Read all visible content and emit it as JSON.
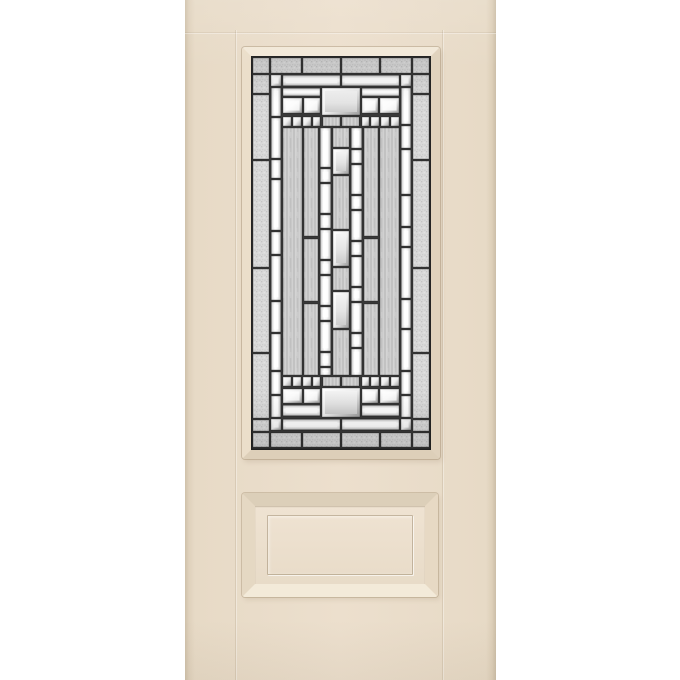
{
  "scene": {
    "background": "#ffffff",
    "subject": "smooth-skin entry door, 3/4 decorative glass lite over one raised panel"
  },
  "door": {
    "colors": {
      "bg": "#ffffff",
      "face": "#e9dcc9",
      "face_hi": "#ecdfcd",
      "trim": "#e7dac6",
      "edge": "#ccbea7"
    },
    "lite": {
      "caming": "#383838",
      "caming_edge": "#242424",
      "palette": {
        "granite_glass": "#d9d9d9",
        "streaked_glass": "#cacaca",
        "bevel_white": "#ffffff",
        "bevel_edge": "#6e6e6e",
        "frost_panel": "#e4e4e4"
      },
      "kinds": {
        "g": "granite-textured-border-glass",
        "s": "streaked-glass",
        "v": "vertical-bevel-bar",
        "h": "horizontal-bevel-bar",
        "q": "bevel-square",
        "d": "dentil-square",
        "f": "bevel-framed-frost-panel"
      },
      "pieces": [
        [
          "g",
          2,
          2,
          16,
          15
        ],
        [
          "g",
          20,
          2,
          30,
          15
        ],
        [
          "g",
          52,
          2,
          37,
          15
        ],
        [
          "g",
          91,
          2,
          37,
          15
        ],
        [
          "g",
          130,
          2,
          30,
          15
        ],
        [
          "g",
          162,
          2,
          16,
          15
        ],
        [
          "g",
          2,
          19,
          16,
          18
        ],
        [
          "g",
          2,
          39,
          16,
          64
        ],
        [
          "g",
          2,
          105,
          16,
          106
        ],
        [
          "g",
          2,
          213,
          16,
          83
        ],
        [
          "g",
          2,
          298,
          16,
          64
        ],
        [
          "g",
          2,
          364,
          16,
          11
        ],
        [
          "g",
          162,
          19,
          16,
          18
        ],
        [
          "g",
          162,
          39,
          16,
          64
        ],
        [
          "g",
          162,
          105,
          16,
          106
        ],
        [
          "g",
          162,
          213,
          16,
          83
        ],
        [
          "g",
          162,
          298,
          16,
          64
        ],
        [
          "g",
          162,
          364,
          16,
          11
        ],
        [
          "g",
          2,
          377,
          16,
          14
        ],
        [
          "g",
          20,
          377,
          30,
          14
        ],
        [
          "g",
          52,
          377,
          37,
          14
        ],
        [
          "g",
          91,
          377,
          37,
          14
        ],
        [
          "g",
          130,
          377,
          30,
          14
        ],
        [
          "g",
          162,
          377,
          16,
          14
        ],
        [
          "v",
          20,
          32,
          10,
          28
        ],
        [
          "v",
          20,
          62,
          10,
          40
        ],
        [
          "v",
          20,
          104,
          10,
          18
        ],
        [
          "v",
          20,
          124,
          10,
          50
        ],
        [
          "v",
          20,
          176,
          10,
          22
        ],
        [
          "v",
          20,
          200,
          10,
          44
        ],
        [
          "v",
          20,
          246,
          10,
          30
        ],
        [
          "v",
          20,
          278,
          10,
          36
        ],
        [
          "v",
          20,
          316,
          10,
          22
        ],
        [
          "v",
          20,
          340,
          10,
          21
        ],
        [
          "v",
          150,
          32,
          10,
          36
        ],
        [
          "v",
          150,
          70,
          10,
          22
        ],
        [
          "v",
          150,
          94,
          10,
          44
        ],
        [
          "v",
          150,
          140,
          10,
          30
        ],
        [
          "v",
          150,
          172,
          10,
          18
        ],
        [
          "v",
          150,
          192,
          10,
          50
        ],
        [
          "v",
          150,
          244,
          10,
          28
        ],
        [
          "v",
          150,
          274,
          10,
          40
        ],
        [
          "v",
          150,
          316,
          10,
          22
        ],
        [
          "v",
          150,
          340,
          10,
          21
        ],
        [
          "q",
          20,
          19,
          10,
          11
        ],
        [
          "q",
          150,
          19,
          10,
          11
        ],
        [
          "q",
          20,
          363,
          10,
          11
        ],
        [
          "q",
          150,
          363,
          10,
          11
        ],
        [
          "h",
          32,
          19,
          57,
          11
        ],
        [
          "h",
          91,
          19,
          57,
          11
        ],
        [
          "h",
          32,
          32,
          37,
          8
        ],
        [
          "h",
          111,
          32,
          37,
          8
        ],
        [
          "f",
          71,
          32,
          38,
          27
        ],
        [
          "q",
          32,
          42,
          19,
          15
        ],
        [
          "q",
          53,
          42,
          16,
          15
        ],
        [
          "q",
          111,
          42,
          16,
          15
        ],
        [
          "q",
          129,
          42,
          19,
          15
        ],
        [
          "d",
          32,
          61,
          8,
          9
        ],
        [
          "d",
          42,
          61,
          8,
          9
        ],
        [
          "d",
          52,
          61,
          8,
          9
        ],
        [
          "d",
          62,
          61,
          7,
          9
        ],
        [
          "d",
          111,
          61,
          7,
          9
        ],
        [
          "d",
          120,
          61,
          8,
          9
        ],
        [
          "d",
          130,
          61,
          8,
          9
        ],
        [
          "d",
          140,
          61,
          8,
          9
        ],
        [
          "s",
          72,
          61,
          17,
          9
        ],
        [
          "s",
          91,
          61,
          17,
          9
        ],
        [
          "s",
          32,
          72,
          19,
          247
        ],
        [
          "s",
          129,
          72,
          19,
          247
        ],
        [
          "s",
          53,
          72,
          14,
          108
        ],
        [
          "s",
          53,
          183,
          14,
          62
        ],
        [
          "s",
          53,
          248,
          14,
          71
        ],
        [
          "s",
          113,
          72,
          14,
          108
        ],
        [
          "s",
          113,
          183,
          14,
          62
        ],
        [
          "s",
          113,
          248,
          14,
          71
        ],
        [
          "v",
          69,
          72,
          11,
          39
        ],
        [
          "v",
          69,
          113,
          11,
          13
        ],
        [
          "v",
          69,
          128,
          11,
          29
        ],
        [
          "v",
          69,
          159,
          11,
          13
        ],
        [
          "v",
          69,
          174,
          11,
          29
        ],
        [
          "v",
          69,
          205,
          11,
          13
        ],
        [
          "v",
          69,
          220,
          11,
          29
        ],
        [
          "v",
          69,
          251,
          11,
          13
        ],
        [
          "v",
          69,
          266,
          11,
          29
        ],
        [
          "v",
          69,
          297,
          11,
          13
        ],
        [
          "v",
          69,
          312,
          11,
          7
        ],
        [
          "v",
          100,
          72,
          11,
          20
        ],
        [
          "v",
          100,
          94,
          11,
          13
        ],
        [
          "v",
          100,
          109,
          11,
          29
        ],
        [
          "v",
          100,
          140,
          11,
          13
        ],
        [
          "v",
          100,
          155,
          11,
          29
        ],
        [
          "v",
          100,
          186,
          11,
          13
        ],
        [
          "v",
          100,
          201,
          11,
          29
        ],
        [
          "v",
          100,
          232,
          11,
          13
        ],
        [
          "v",
          100,
          247,
          11,
          29
        ],
        [
          "v",
          100,
          278,
          11,
          13
        ],
        [
          "v",
          100,
          293,
          11,
          26
        ],
        [
          "s",
          82,
          72,
          16,
          19
        ],
        [
          "f",
          82,
          93,
          16,
          25
        ],
        [
          "s",
          82,
          120,
          16,
          53
        ],
        [
          "f",
          82,
          175,
          16,
          35
        ],
        [
          "s",
          82,
          212,
          16,
          22
        ],
        [
          "f",
          82,
          236,
          16,
          36
        ],
        [
          "s",
          82,
          274,
          16,
          45
        ],
        [
          "d",
          32,
          321,
          8,
          9
        ],
        [
          "d",
          42,
          321,
          8,
          9
        ],
        [
          "d",
          52,
          321,
          8,
          9
        ],
        [
          "d",
          62,
          321,
          7,
          9
        ],
        [
          "d",
          111,
          321,
          7,
          9
        ],
        [
          "d",
          120,
          321,
          8,
          9
        ],
        [
          "d",
          130,
          321,
          8,
          9
        ],
        [
          "d",
          140,
          321,
          8,
          9
        ],
        [
          "s",
          72,
          321,
          17,
          9
        ],
        [
          "s",
          91,
          321,
          17,
          9
        ],
        [
          "q",
          32,
          333,
          19,
          14
        ],
        [
          "q",
          53,
          333,
          16,
          14
        ],
        [
          "q",
          111,
          333,
          16,
          14
        ],
        [
          "q",
          129,
          333,
          19,
          14
        ],
        [
          "f",
          71,
          332,
          38,
          29
        ],
        [
          "h",
          32,
          349,
          37,
          11
        ],
        [
          "h",
          111,
          349,
          37,
          11
        ],
        [
          "h",
          32,
          363,
          57,
          11
        ],
        [
          "h",
          91,
          363,
          57,
          11
        ]
      ]
    }
  }
}
